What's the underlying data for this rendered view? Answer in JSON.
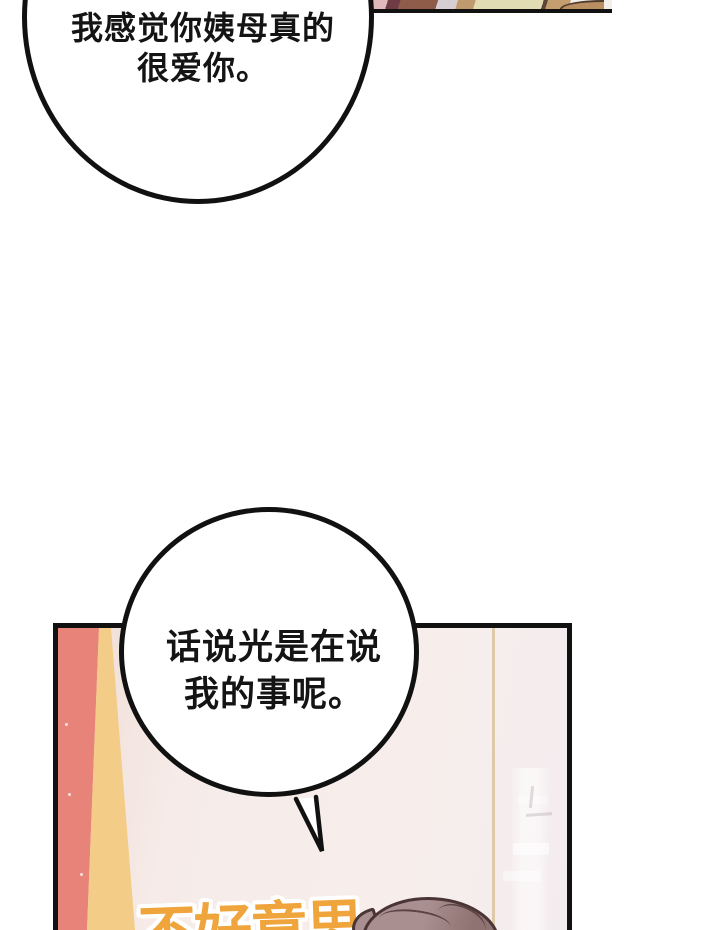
{
  "page_background": "#ffffff",
  "bubbles": [
    {
      "id": "bubble-1",
      "speaker_hint": "off-panel",
      "lines": [
        "我感觉你姨母真的",
        "很爱你。"
      ]
    },
    {
      "id": "bubble-2",
      "speaker_hint": "off-panel",
      "lines": [
        "话说光是在说",
        "我的事呢。"
      ]
    }
  ],
  "sfx": {
    "text": "不好意思",
    "color": "#f0a43c"
  },
  "colors": {
    "page_bg": "#ffffff",
    "outline": "#111111",
    "curtain_red": "#e8837a",
    "curtain_yellow": "#f3cd87",
    "wall": "#f5eae6",
    "wall_seam": "#d9c29c",
    "hair": "#a98f8f",
    "hair_shadow": "#8f7272",
    "hair_outline": "#4a3434",
    "sfx_orange": "#f0a43c",
    "top_panel_stripe_colors": [
      "#e0b9bd",
      "#6f3b45",
      "#8f5c49",
      "#d6ced3",
      "#c09a6e",
      "#e2dcb3",
      "#c49e6f"
    ]
  }
}
